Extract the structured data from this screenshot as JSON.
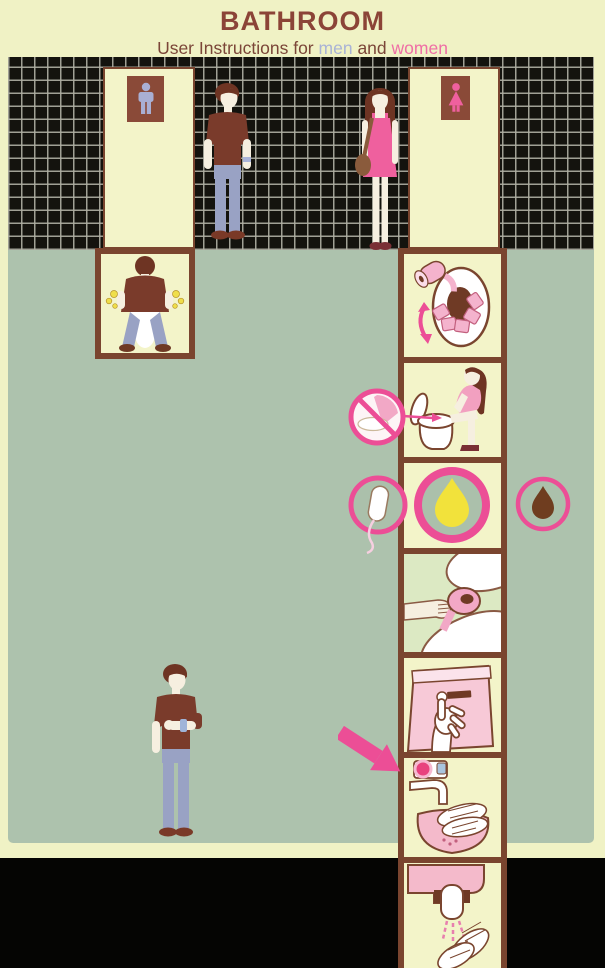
{
  "header": {
    "title": "BATHROOM",
    "subtitle": {
      "prefix": "User Instructions for",
      "men_word": "men",
      "and_word": "and",
      "women_word": "women"
    }
  },
  "doors": {
    "mens_door": {
      "sign_icon": "male-pictogram-icon"
    },
    "womens_door": {
      "sign_icon": "female-pictogram-icon"
    }
  },
  "instructions": {
    "men_steps": [
      {
        "step": 1,
        "icon": "urinate-standing-icon"
      }
    ],
    "women_steps": [
      {
        "step": 1,
        "icon": "cover-seat-with-paper-icon"
      },
      {
        "step": 2,
        "icon": "hover-over-toilet-icon"
      },
      {
        "step": 3,
        "icon": "urine-drop-icon"
      },
      {
        "step": 4,
        "icon": "wipe-with-paper-icon"
      },
      {
        "step": 5,
        "icon": "press-flush-button-icon"
      },
      {
        "step": 6,
        "icon": "wash-hands-with-soap-icon"
      },
      {
        "step": 7,
        "icon": "dry-hands-icon"
      }
    ],
    "badges": [
      {
        "icon": "no-seat-contact-icon"
      },
      {
        "icon": "tampon-icon"
      },
      {
        "icon": "poop-drop-icon"
      },
      {
        "icon": "soap-pointer-arrow-icon"
      }
    ],
    "figures": [
      {
        "icon": "man-waiting-at-mens-door-icon"
      },
      {
        "icon": "woman-at-womens-door-icon"
      },
      {
        "icon": "man-checking-watch-icon"
      }
    ]
  },
  "colors": {
    "page_bg": "#f0f2c5",
    "title_brown": "#8b4437",
    "men_blue": "#a9b3d6",
    "women_pink": "#ef6fa5",
    "tile_black": "#14130e",
    "grout": "#b0b0a4",
    "floor_green": "#adc2ad",
    "frame_brown": "#7a452f",
    "panel_bg": "#f3f4c9",
    "accent_pink": "#ec4e96",
    "paper_pink": "#f4b3cd",
    "sink_pink": "#f4bacb",
    "shirt_brown": "#7a3b2b",
    "jeans_blue": "#99a2c4",
    "hair_brown": "#6e3423",
    "skin": "#f6efe0",
    "urine_yellow": "#f2e23b",
    "poop_brown": "#6f3d1f"
  }
}
